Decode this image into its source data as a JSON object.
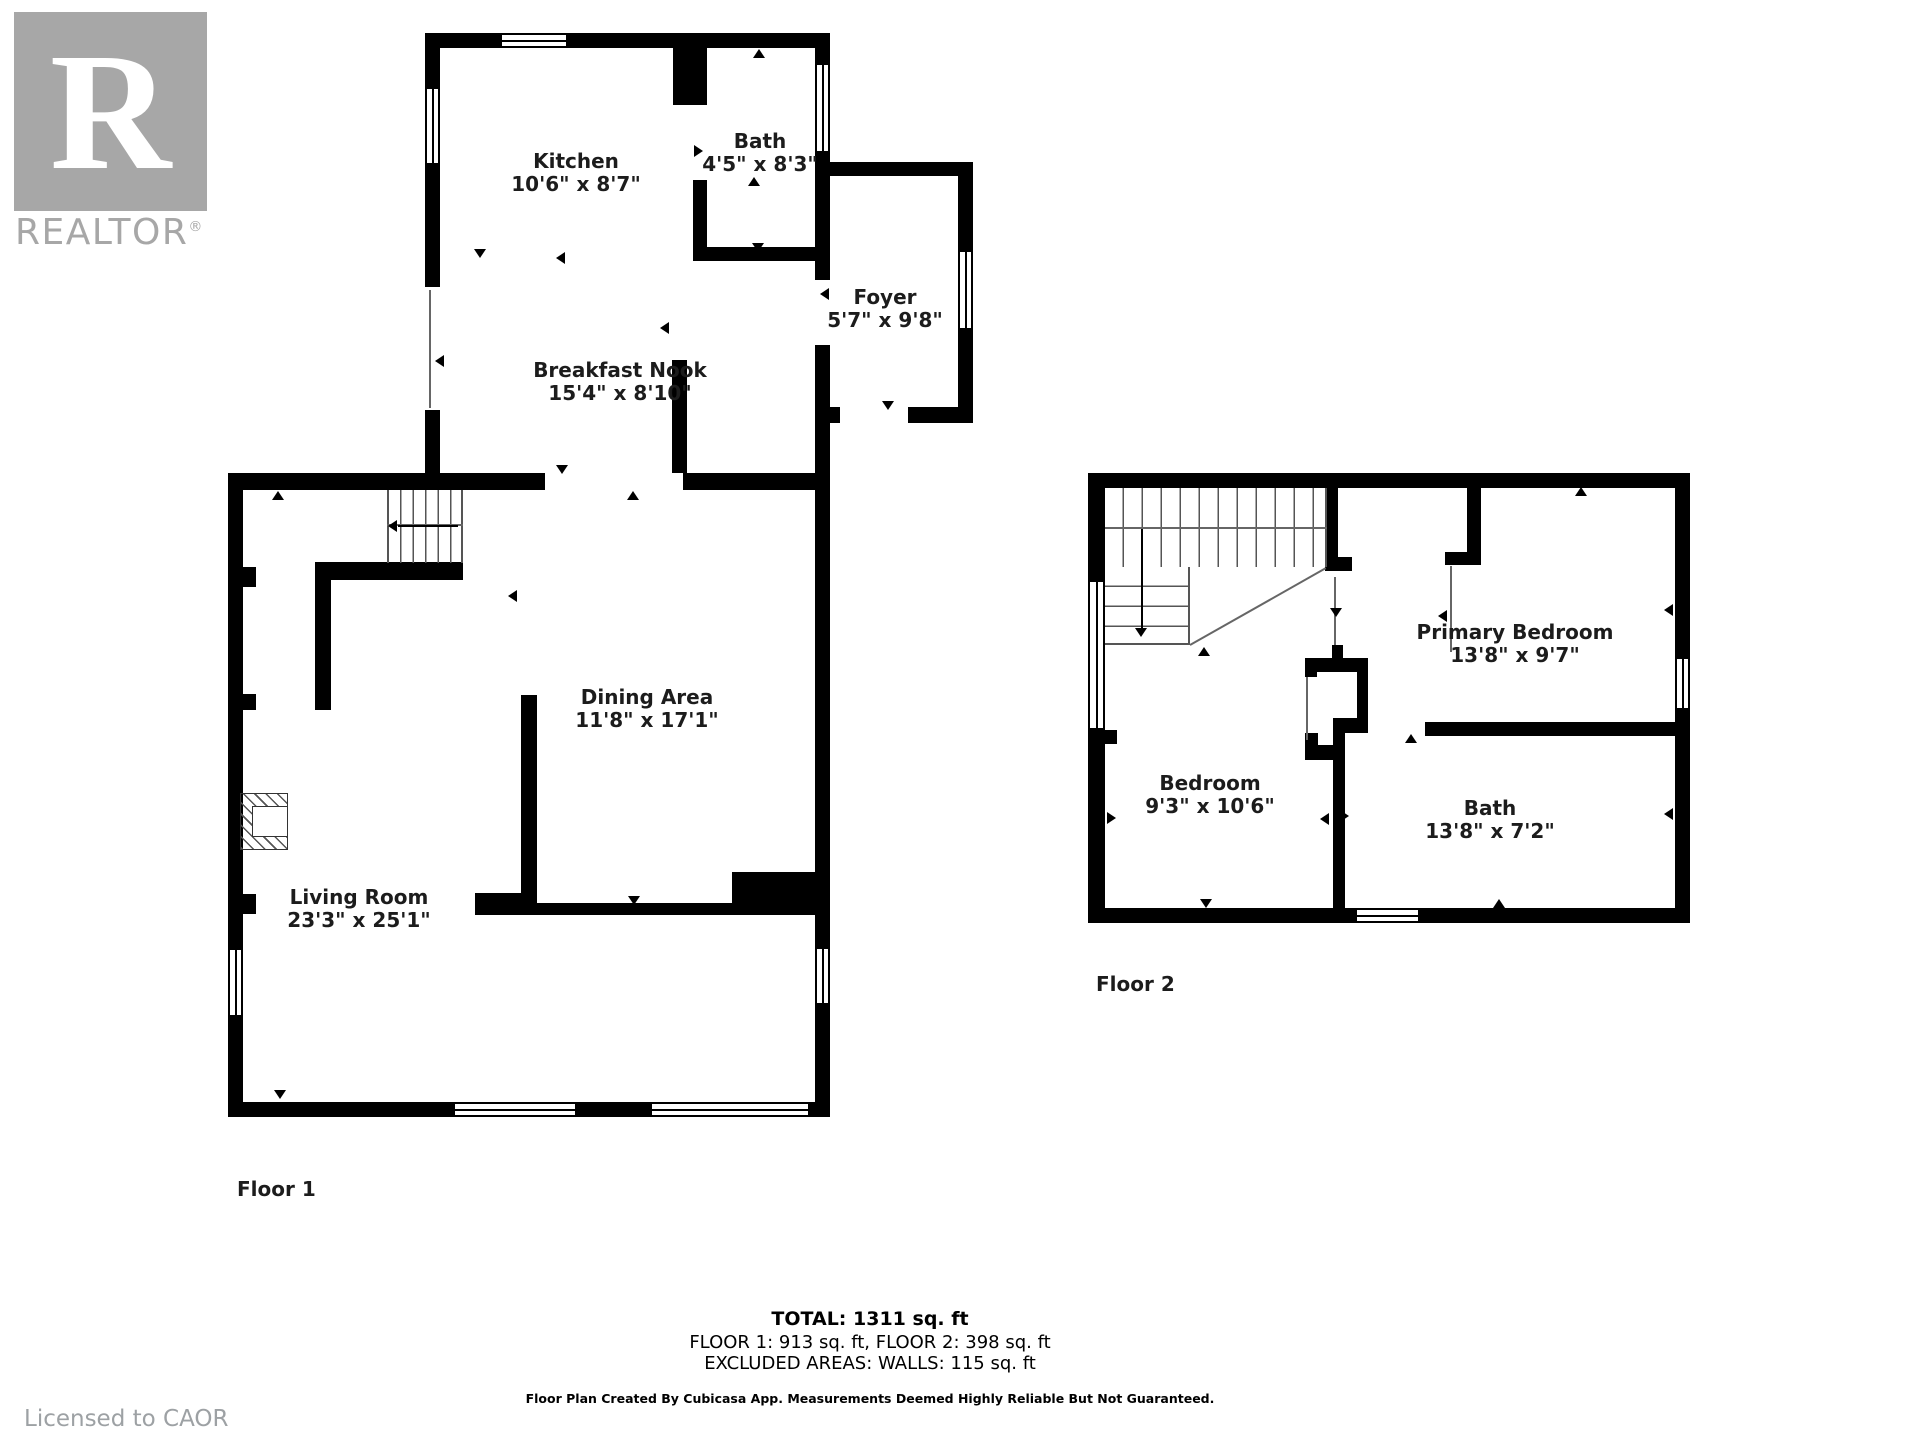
{
  "logo": {
    "letter": "R",
    "brand": "REALTOR",
    "registered": "®"
  },
  "floor1": {
    "label": "Floor 1",
    "rooms": [
      {
        "name": "Kitchen",
        "dims": "10'6\" x 8'7\""
      },
      {
        "name": "Bath",
        "dims": "4'5\" x 8'3\""
      },
      {
        "name": "Foyer",
        "dims": "5'7\" x 9'8\""
      },
      {
        "name": "Breakfast Nook",
        "dims": "15'4\" x 8'10\""
      },
      {
        "name": "Dining Area",
        "dims": "11'8\" x 17'1\""
      },
      {
        "name": "Living Room",
        "dims": "23'3\" x 25'1\""
      }
    ]
  },
  "floor2": {
    "label": "Floor 2",
    "rooms": [
      {
        "name": "Primary Bedroom",
        "dims": "13'8\" x 9'7\""
      },
      {
        "name": "Bedroom",
        "dims": "9'3\" x 10'6\""
      },
      {
        "name": "Bath",
        "dims": "13'8\" x 7'2\""
      }
    ]
  },
  "footer": {
    "total": "TOTAL: 1311 sq. ft",
    "floors": "FLOOR 1: 913 sq. ft, FLOOR 2: 398 sq. ft",
    "excluded": "EXCLUDED AREAS: WALLS: 115 sq. ft",
    "disclaimer": "Floor Plan Created By Cubicasa App. Measurements Deemed Highly Reliable But Not Guaranteed."
  },
  "license": "Licensed to CAOR",
  "colors": {
    "wall": "#000000",
    "logo_gray": "#a7a7a7",
    "license_gray": "#9da1a4"
  }
}
